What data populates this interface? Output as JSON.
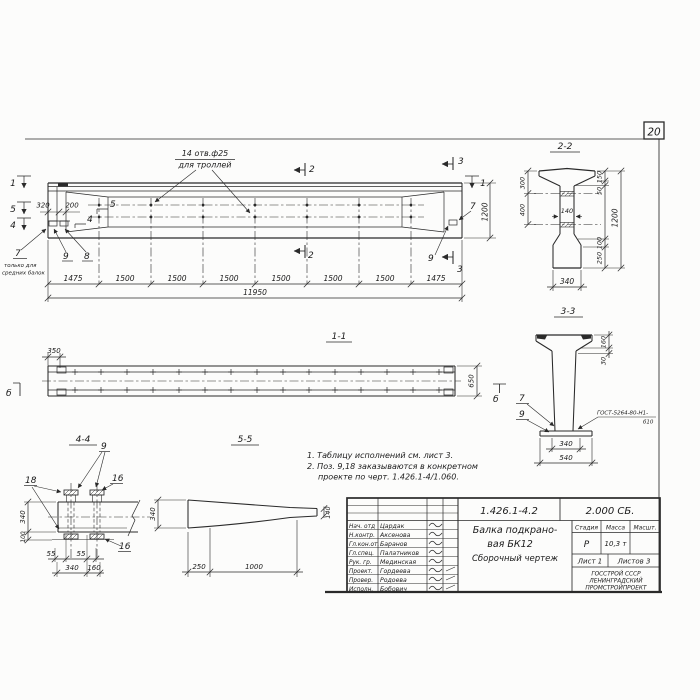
{
  "sheet": {
    "page_number": "20"
  },
  "elevation": {
    "callout1": "14 отв.ф25",
    "callout2": "для троллей",
    "note7_1": "только для",
    "note7_2": "средних балок",
    "dim320": "320",
    "dim200": "200",
    "dim1200": "1200",
    "total": "11950",
    "segs": [
      "1475",
      "1500",
      "1500",
      "1500",
      "1500",
      "1500",
      "1500",
      "1475"
    ],
    "pos": {
      "p4": "4",
      "p5": "5",
      "p7": "7",
      "p8": "8",
      "p9": "9",
      "p7r": "7",
      "p9r": "9"
    },
    "cuts": {
      "c1l": "1",
      "c5": "5",
      "c4": "4",
      "c2t": "2",
      "c2b": "2",
      "c3t": "3",
      "c3b": "3",
      "c1r": "1"
    }
  },
  "sec11": {
    "title": "1-1",
    "dim350": "350",
    "dim650": "650",
    "view_b_left": "б",
    "view_b_right": "б"
  },
  "sec22": {
    "title": "2-2",
    "d300": "300",
    "d400": "400",
    "d140": "140",
    "d150": "150",
    "d50": "50",
    "d1200": "1200",
    "d100": "100",
    "d250": "250",
    "d340": "340"
  },
  "sec33": {
    "title": "3-3",
    "d160": "160",
    "d30": "30",
    "p7": "7",
    "p9": "9",
    "weld1": "ГОСТ-5264-80-Н1-",
    "weld2": "б10",
    "d340": "340",
    "d540": "540"
  },
  "sec44": {
    "title": "4-4",
    "p9": "9",
    "p18": "18",
    "p16a": "16",
    "p16b": "16",
    "d340": "340",
    "d100": "100",
    "d55a": "55",
    "d55b": "55",
    "d340b": "340",
    "d160": "160"
  },
  "sec55": {
    "title": "5-5",
    "d340": "340",
    "d140": "140",
    "d250": "250",
    "d1000": "1000"
  },
  "notes": {
    "line1": "1. Таблицу исполнений см. лист 3.",
    "line2": "2. Поз. 9,18 заказываются в конкретном",
    "line3": "проекте по черт. 1.426.1-4/1.060."
  },
  "titleblock": {
    "doc_number": "1.426.1-4.2",
    "doc_code": "2.000 СБ.",
    "title1": "Балка подкрано-",
    "title2": "вая БК12",
    "title3": "Сборочный чертеж",
    "col_stage": "Стадия",
    "col_mass": "Масса",
    "col_scale": "Масшт.",
    "stage": "Р",
    "mass": "10,3 т",
    "scale": "",
    "sheet_label": "Лист 1",
    "sheets_label": "Листов 3",
    "org1": "ГОССТРОЙ СССР",
    "org2": "ЛЕНИНГРАДСКИЙ",
    "org3": "ПРОМСТРОЙПРОЕКТ",
    "rows": [
      {
        "role": "Нач. отд",
        "name": "Цардак"
      },
      {
        "role": "Н.контр.",
        "name": "Аксенова"
      },
      {
        "role": "Гл.кон.от.",
        "name": "Баранов"
      },
      {
        "role": "Гл.спец.",
        "name": "Палатников"
      },
      {
        "role": "Рук. гр.",
        "name": "Мединская"
      },
      {
        "role": "Проект.",
        "name": "Гордеева"
      },
      {
        "role": "Провер.",
        "name": "Родоева"
      },
      {
        "role": "Исполн.",
        "name": "Бобович"
      }
    ]
  }
}
